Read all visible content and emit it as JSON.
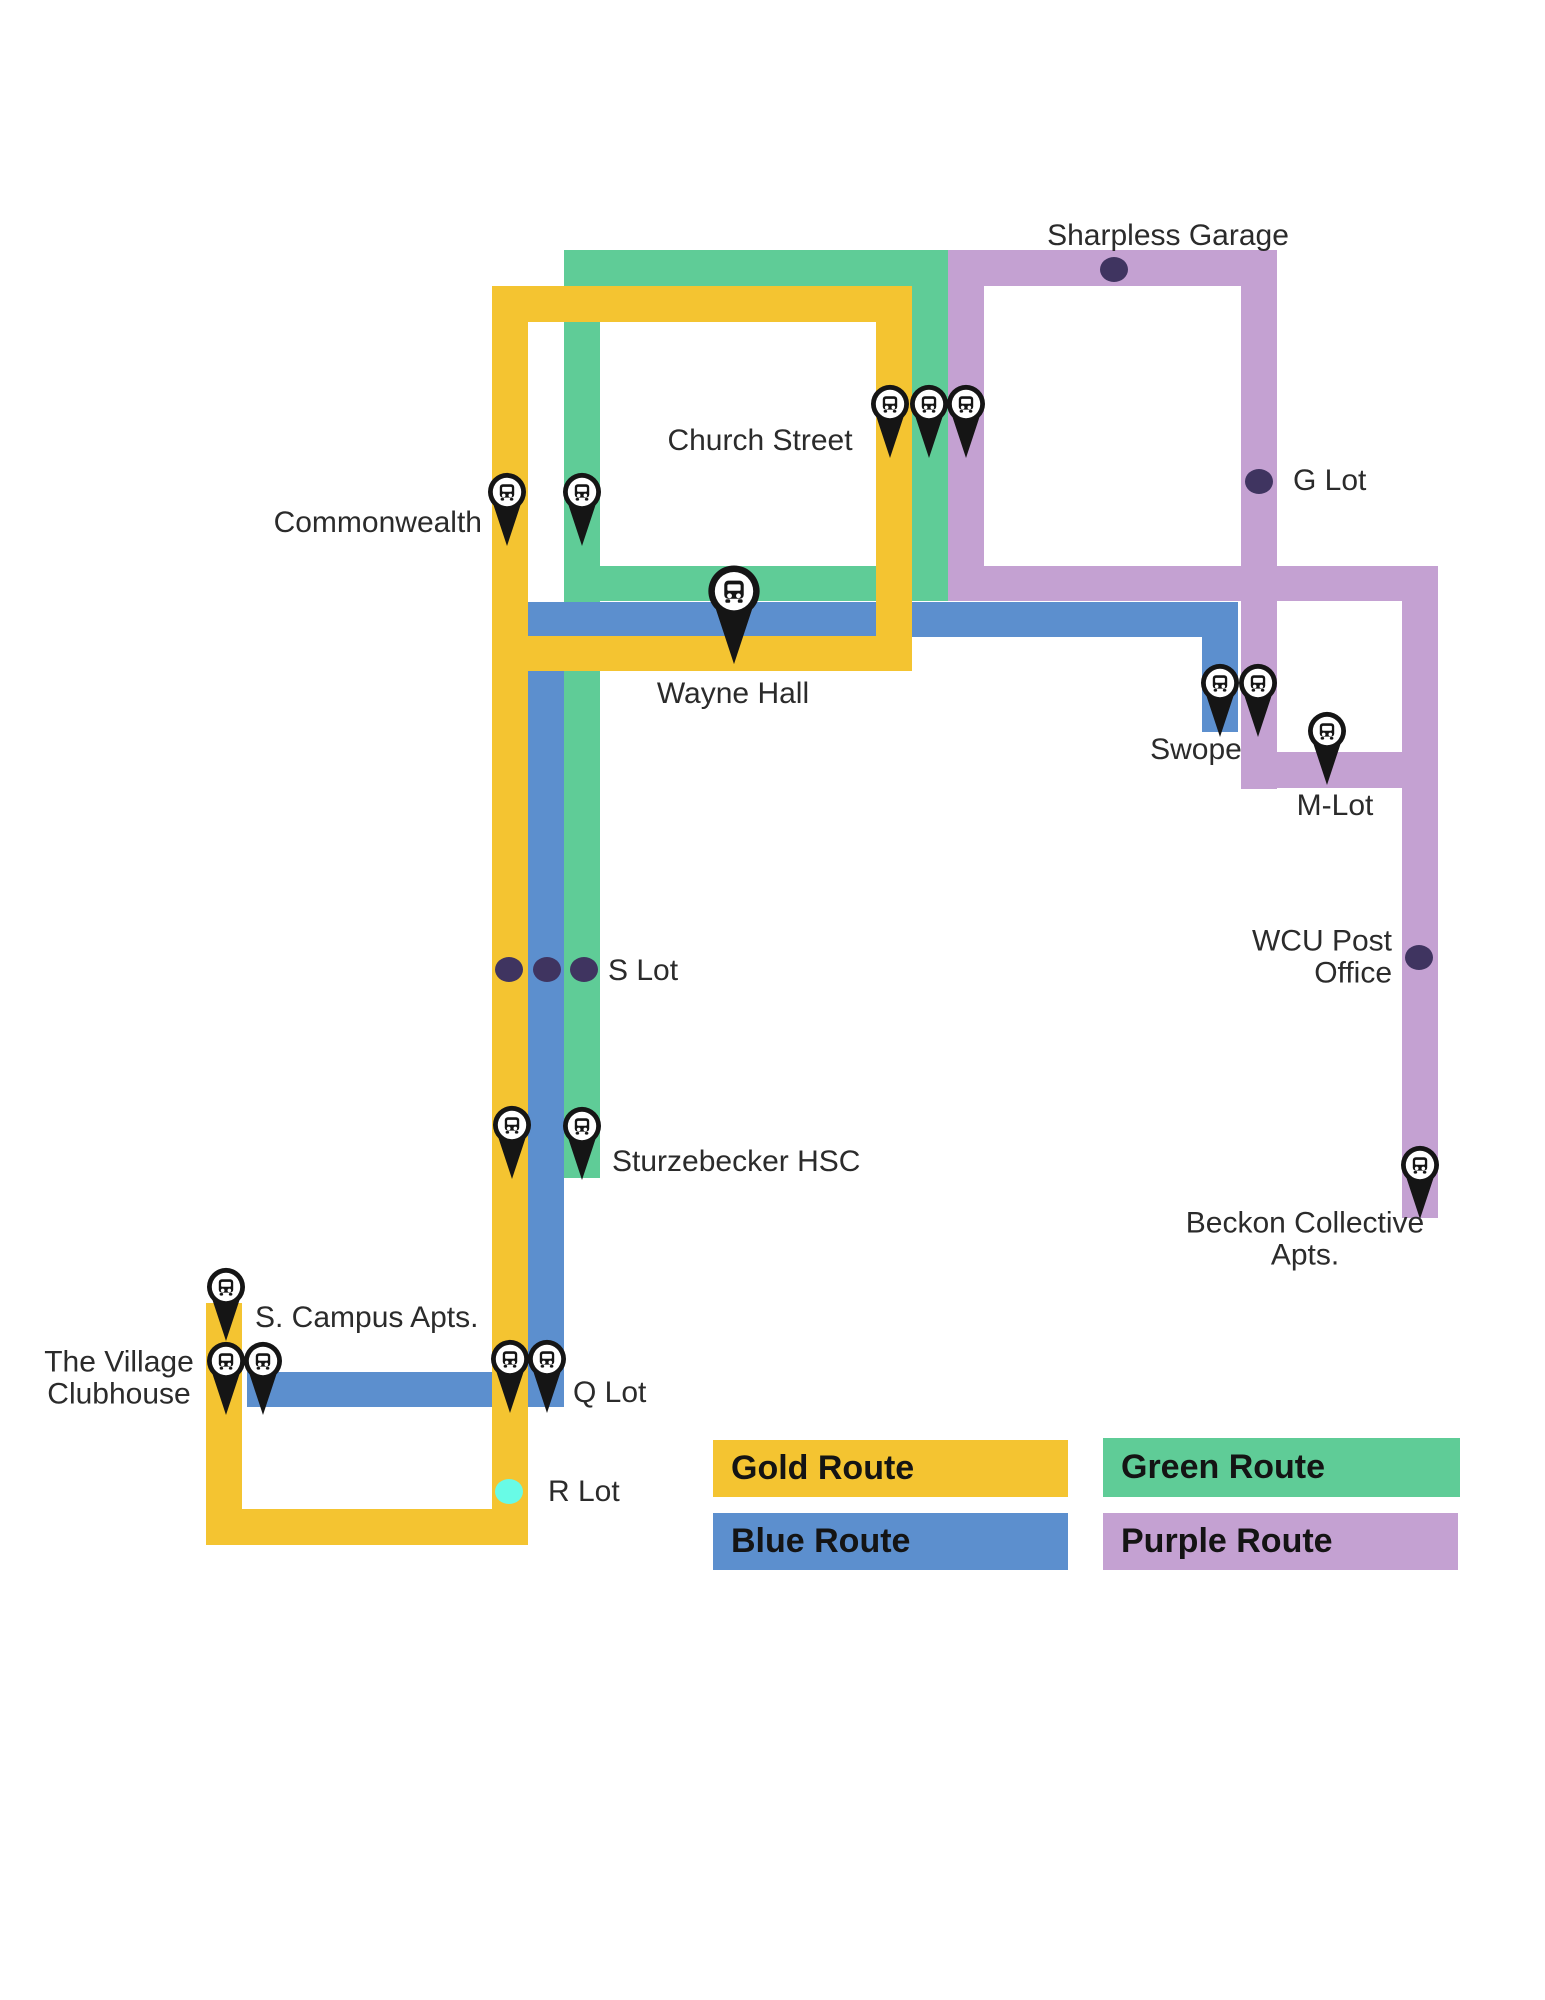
{
  "map": {
    "width": 1545,
    "height": 2000,
    "background": "#ffffff",
    "routes": [
      {
        "id": "green",
        "name": "Green Route",
        "color": "#5FCC97",
        "segments": [
          [
            564,
            250,
            384,
            36
          ],
          [
            564,
            250,
            36,
            928
          ],
          [
            912,
            250,
            36,
            351
          ],
          [
            564,
            566,
            384,
            35
          ]
        ]
      },
      {
        "id": "purple",
        "name": "Purple Route",
        "color": "#C4A1D2",
        "segments": [
          [
            948,
            250,
            329,
            36
          ],
          [
            1241,
            250,
            36,
            539
          ],
          [
            948,
            250,
            36,
            351
          ],
          [
            948,
            566,
            490,
            35
          ],
          [
            1402,
            566,
            36,
            652
          ],
          [
            1241,
            752,
            197,
            36
          ]
        ]
      },
      {
        "id": "blue",
        "name": "Blue Route",
        "color": "#5C8FCE",
        "segments": [
          [
            528,
            602,
            710,
            35
          ],
          [
            1202,
            602,
            36,
            130
          ],
          [
            528,
            602,
            36,
            805
          ],
          [
            247,
            1372,
            317,
            35
          ]
        ]
      },
      {
        "id": "gold",
        "name": "Gold Route",
        "color": "#F4C431",
        "segments": [
          [
            492,
            286,
            420,
            36
          ],
          [
            492,
            286,
            36,
            1259
          ],
          [
            876,
            286,
            36,
            385
          ],
          [
            528,
            636,
            384,
            35
          ],
          [
            206,
            1303,
            36,
            242
          ],
          [
            206,
            1509,
            322,
            36
          ]
        ]
      }
    ],
    "stop_dots": [
      {
        "stop": "Sharpless Garage",
        "x": 1114,
        "y": 269
      },
      {
        "stop": "G Lot",
        "x": 1259,
        "y": 481
      },
      {
        "stop": "S Lot",
        "x": 509,
        "y": 969
      },
      {
        "stop": "S Lot",
        "x": 547,
        "y": 969
      },
      {
        "stop": "S Lot",
        "x": 584,
        "y": 969
      },
      {
        "stop": "WCU Post Office",
        "x": 1419,
        "y": 957
      },
      {
        "stop": "R Lot",
        "x": 509,
        "y": 1491,
        "color": "#68FBE6"
      }
    ],
    "pins": [
      {
        "stop": "Church Street",
        "x": 890,
        "y": 404,
        "size": "small"
      },
      {
        "stop": "Church Street",
        "x": 929,
        "y": 404,
        "size": "small"
      },
      {
        "stop": "Church Street",
        "x": 966,
        "y": 404,
        "size": "small"
      },
      {
        "stop": "Commonwealth",
        "x": 507,
        "y": 492,
        "size": "small"
      },
      {
        "stop": "Commonwealth",
        "x": 582,
        "y": 492,
        "size": "small"
      },
      {
        "stop": "Wayne Hall",
        "x": 734,
        "y": 591,
        "size": "large"
      },
      {
        "stop": "Swope",
        "x": 1220,
        "y": 683,
        "size": "small"
      },
      {
        "stop": "Swope",
        "x": 1258,
        "y": 683,
        "size": "small"
      },
      {
        "stop": "M-Lot",
        "x": 1327,
        "y": 731,
        "size": "small"
      },
      {
        "stop": "Sturzebecker HSC",
        "x": 512,
        "y": 1125,
        "size": "small"
      },
      {
        "stop": "Sturzebecker HSC",
        "x": 582,
        "y": 1126,
        "size": "small"
      },
      {
        "stop": "S. Campus Apts.",
        "x": 226,
        "y": 1287,
        "size": "small"
      },
      {
        "stop": "The Village Clubhouse",
        "x": 226,
        "y": 1361,
        "size": "small"
      },
      {
        "stop": "The Village Clubhouse",
        "x": 263,
        "y": 1361,
        "size": "small"
      },
      {
        "stop": "Q Lot",
        "x": 510,
        "y": 1359,
        "size": "small"
      },
      {
        "stop": "Q Lot",
        "x": 547,
        "y": 1359,
        "size": "small"
      },
      {
        "stop": "Beckon Collective Apts.",
        "x": 1420,
        "y": 1165,
        "size": "small"
      }
    ],
    "labels": [
      {
        "text": "Sharpless Garage",
        "x": 1168,
        "y": 236,
        "align": "center"
      },
      {
        "text": "G Lot",
        "x": 1293,
        "y": 481,
        "align": "left"
      },
      {
        "text": "Church Street",
        "x": 760,
        "y": 441,
        "align": "center"
      },
      {
        "text": "Commonwealth",
        "x": 482,
        "y": 523,
        "align": "right"
      },
      {
        "text": "Wayne Hall",
        "x": 733,
        "y": 694,
        "align": "center"
      },
      {
        "text": "Swope",
        "x": 1196,
        "y": 750,
        "align": "center"
      },
      {
        "text": "M-Lot",
        "x": 1335,
        "y": 806,
        "align": "center"
      },
      {
        "text": "WCU Post Office",
        "x": 1392,
        "y": 958,
        "align": "right"
      },
      {
        "text": "S Lot",
        "x": 608,
        "y": 971,
        "align": "left"
      },
      {
        "text": "Sturzebecker HSC",
        "x": 612,
        "y": 1162,
        "align": "left"
      },
      {
        "text": "Beckon Collective Apts.",
        "x": 1305,
        "y": 1240,
        "align": "center"
      },
      {
        "text": "S. Campus Apts.",
        "x": 255,
        "y": 1318,
        "align": "left"
      },
      {
        "text": "The Village\nClubhouse",
        "x": 119,
        "y": 1379,
        "align": "center"
      },
      {
        "text": "Q Lot",
        "x": 573,
        "y": 1393,
        "align": "left"
      },
      {
        "text": "R Lot",
        "x": 548,
        "y": 1492,
        "align": "left"
      }
    ]
  },
  "legend": {
    "items": [
      {
        "label": "Gold Route",
        "color": "#F4C431"
      },
      {
        "label": "Green Route",
        "color": "#5FCC97"
      },
      {
        "label": "Blue Route",
        "color": "#5C8FCE"
      },
      {
        "label": "Purple Route",
        "color": "#C4A1D2"
      }
    ]
  },
  "colors": {
    "stop_dot": "#3F3460",
    "r_lot_dot": "#68FBE6",
    "pin": "#151515",
    "label_text": "#2B2B2B",
    "legend_text": "#141414"
  }
}
